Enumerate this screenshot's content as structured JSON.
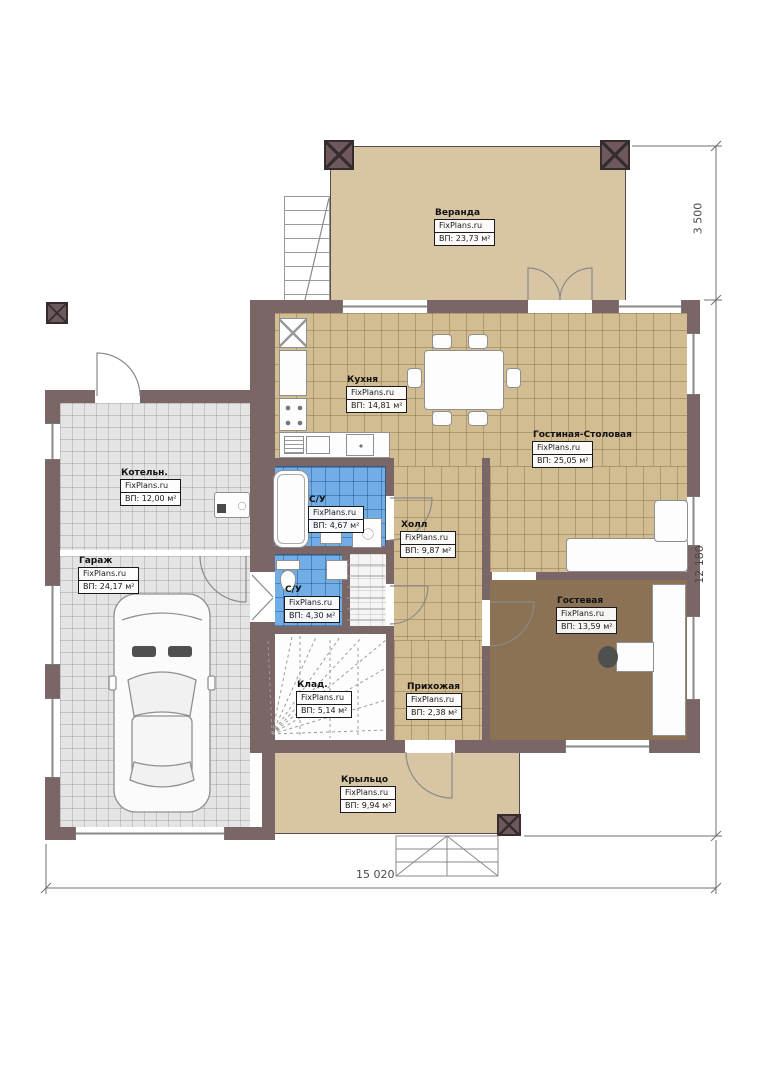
{
  "watermark": "FixPlans.ru",
  "rooms": [
    {
      "id": "veranda",
      "name": "Веранда",
      "area": "ВП: 23,73 м²"
    },
    {
      "id": "kitchen",
      "name": "Кухня",
      "area": "ВП: 14,81 м²"
    },
    {
      "id": "living",
      "name": "Гостиная-Столовая",
      "area": "ВП: 25,05 м²"
    },
    {
      "id": "boiler",
      "name": "Котельн.",
      "area": "ВП: 12,00 м²"
    },
    {
      "id": "garage",
      "name": "Гараж",
      "area": "ВП: 24,17 м²"
    },
    {
      "id": "bath1",
      "name": "С/У",
      "area": "ВП: 4,67 м²"
    },
    {
      "id": "hall",
      "name": "Холл",
      "area": "ВП: 9,87 м²"
    },
    {
      "id": "bath2",
      "name": "С/У",
      "area": "ВП: 4,30 м²"
    },
    {
      "id": "guest",
      "name": "Гостевая",
      "area": "ВП: 13,59 м²"
    },
    {
      "id": "storage",
      "name": "Клад.",
      "area": "ВП: 5,14 м²"
    },
    {
      "id": "entry",
      "name": "Прихожая",
      "area": "ВП: 2,38 м²"
    },
    {
      "id": "porch",
      "name": "Крыльцо",
      "area": "ВП: 9,94 м²"
    }
  ],
  "dimensions": {
    "veranda_depth": "3 500",
    "house_depth": "12 180",
    "house_width": "15 020"
  },
  "colors": {
    "wall": "#7b6667",
    "floor_tan": "#d7c5a4",
    "floor_tan_grid": "#d2bc92",
    "floor_grey": "#e4e4e4",
    "floor_blue": "#72aee6",
    "floor_brown": "#8b7254"
  }
}
